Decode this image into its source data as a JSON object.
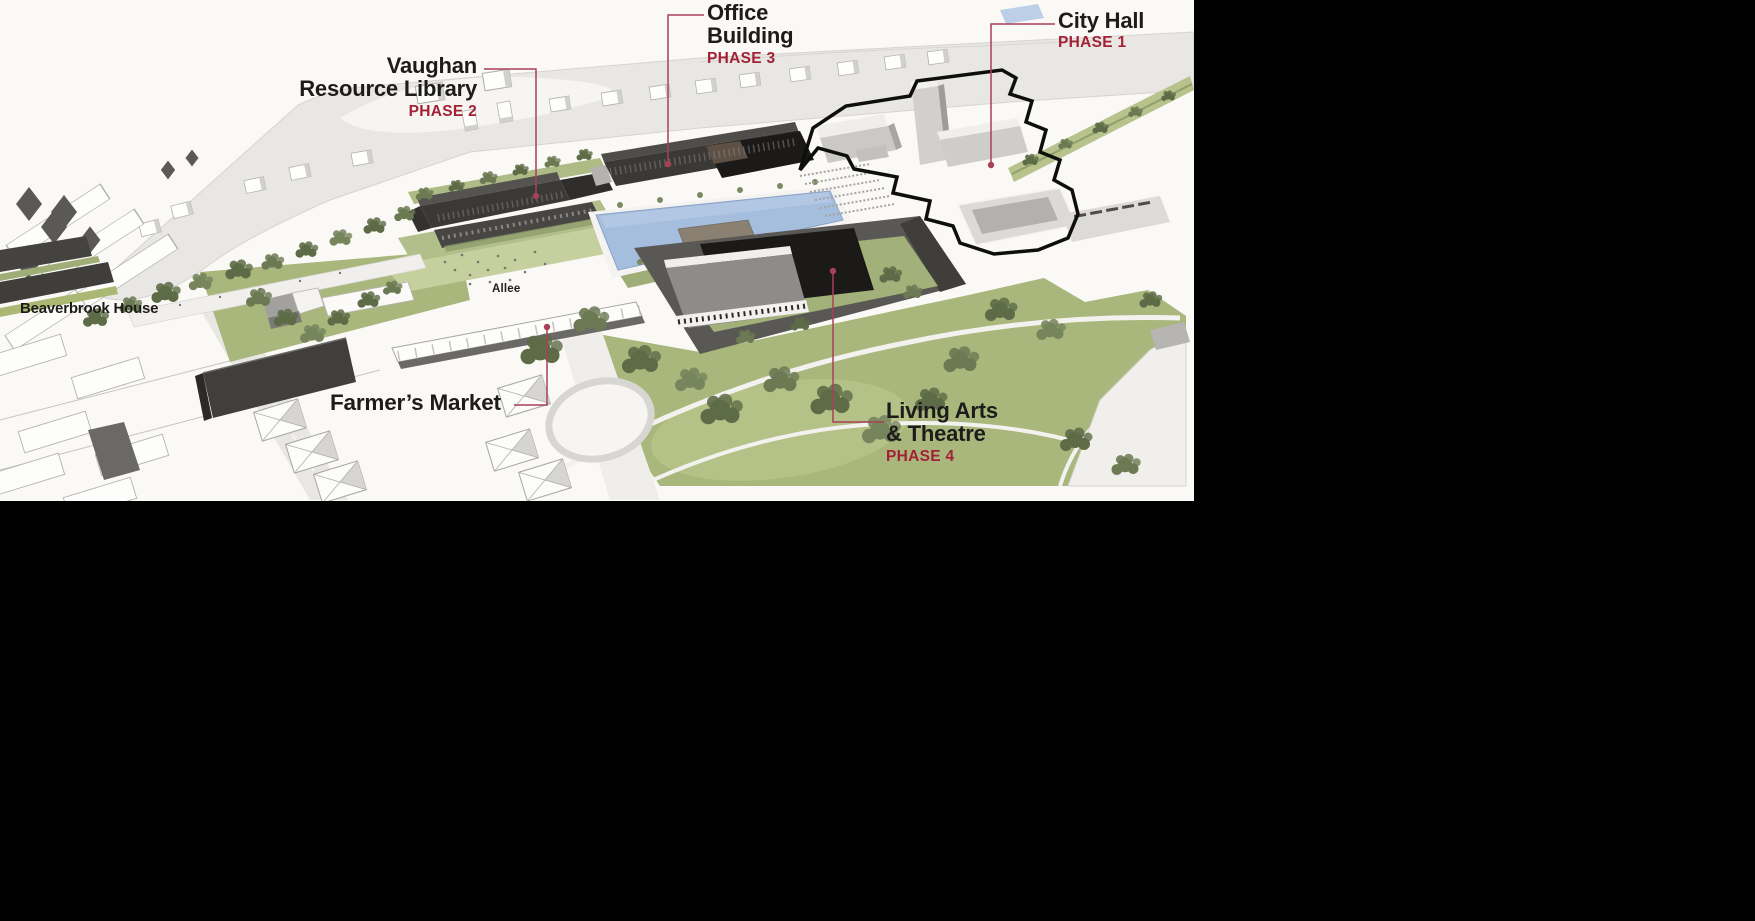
{
  "labels": {
    "vaughan": {
      "line1": "Vaughan",
      "line2": "Resource Library",
      "phase": "PHASE 2"
    },
    "office": {
      "line1": "Office",
      "line2": "Building",
      "phase": "PHASE 3"
    },
    "city_hall": {
      "line1": "City Hall",
      "phase": "PHASE 1"
    },
    "living_arts": {
      "line1": "Living Arts",
      "line2": "& Theatre",
      "phase": "PHASE 4"
    },
    "beaverbrook": {
      "text": "Beaverbrook House"
    },
    "farmers_market": {
      "text": "Farmer’s Market"
    },
    "allee": {
      "text": "Allee"
    }
  },
  "colors": {
    "page-bg": "#000000",
    "render-bg": "#faf9f6",
    "label-text": "#1d1c1b",
    "phase-red": "#a32135",
    "leader": "#a84058",
    "road": "#e9e7e3",
    "park-green": "#a9b67c",
    "tree-green": "#5d6c47",
    "pool-blue": "#a6bedd",
    "dark-building": "#3a3936",
    "black-roof": "#1b1a19",
    "gray-building": "#d2d0cc",
    "outline-black": "#0e0e0d"
  }
}
